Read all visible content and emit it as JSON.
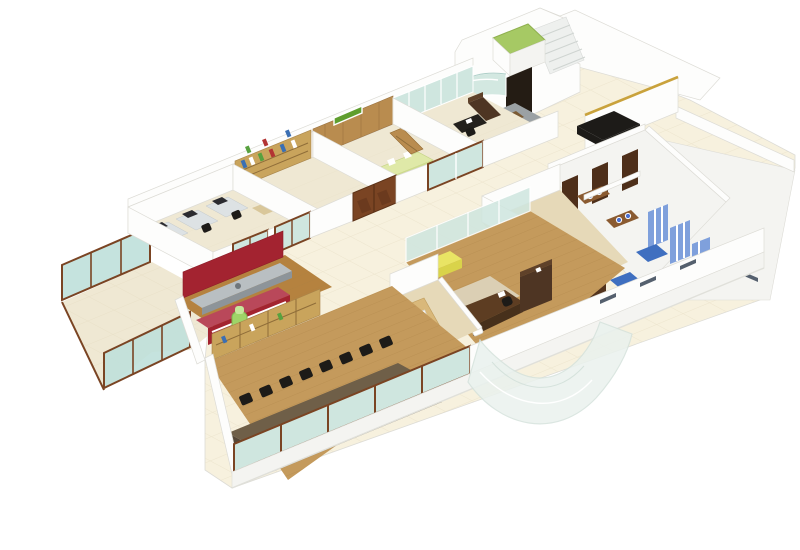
{
  "scene": {
    "type": "3d-isometric-floor-plan",
    "description": "Isometric 3D rendering of an office floor plan with furnished rooms on a white background",
    "background": "#ffffff"
  },
  "palette": {
    "wall": "#fdfdfc",
    "wallSoft": "#f4f4f1",
    "wallEdge": "#dddcd6",
    "cream": "#f7f1de",
    "tileLine": "#e8dfc6",
    "beige": "#efe8d3",
    "woodFloor": "#c49a5c",
    "woodPale": "#e6d9b8",
    "woodMid": "#b98c4f",
    "woodDark": "#53331c",
    "woodDeep": "#6b4226",
    "frame": "#7a4423",
    "glass": "#cfe6df",
    "glassRail": "#bfe0da",
    "red": "#a32330",
    "redLight": "#c24b58",
    "sign": "#5f9e2e",
    "lime": "#a6c964",
    "counterGreen": "#dfe9a8",
    "bottle": "#9fd468",
    "yellow": "#e9e464",
    "gold": "#c9a23c",
    "black": "#1d1b18",
    "grayRug": "#9ba1a4",
    "grayCounter": "#b9bfc2",
    "blueWall": "#7fa0dc",
    "blueFloor": "#3f6fc0",
    "basinBlue": "#4a6fd0",
    "shelf": "#c9a45c",
    "tableDark": "#6f5f48",
    "tableSide": "#564838",
    "tableInlay": "#e6c28e"
  },
  "rooms": [
    {
      "id": "terrace",
      "name": "Glass-railed terrace"
    },
    {
      "id": "workstations",
      "name": "Open workstations"
    },
    {
      "id": "library",
      "name": "Library / shelf room"
    },
    {
      "id": "reception-cabin",
      "name": "Reception cabin with sign"
    },
    {
      "id": "manager-cabin",
      "name": "Manager cabin"
    },
    {
      "id": "entry-lobby",
      "name": "Entry lobby with lift and staircase"
    },
    {
      "id": "waiting-area",
      "name": "Waiting lounge"
    },
    {
      "id": "washrooms",
      "name": "Washroom block"
    },
    {
      "id": "storage",
      "name": "Storage / wardrobe room"
    },
    {
      "id": "executive-office",
      "name": "Executive office"
    },
    {
      "id": "small-washroom",
      "name": "Attached washroom"
    },
    {
      "id": "pantry",
      "name": "Pantry"
    },
    {
      "id": "conference",
      "name": "Conference room"
    },
    {
      "id": "atrium",
      "name": "Curved glass atrium facade"
    }
  ]
}
